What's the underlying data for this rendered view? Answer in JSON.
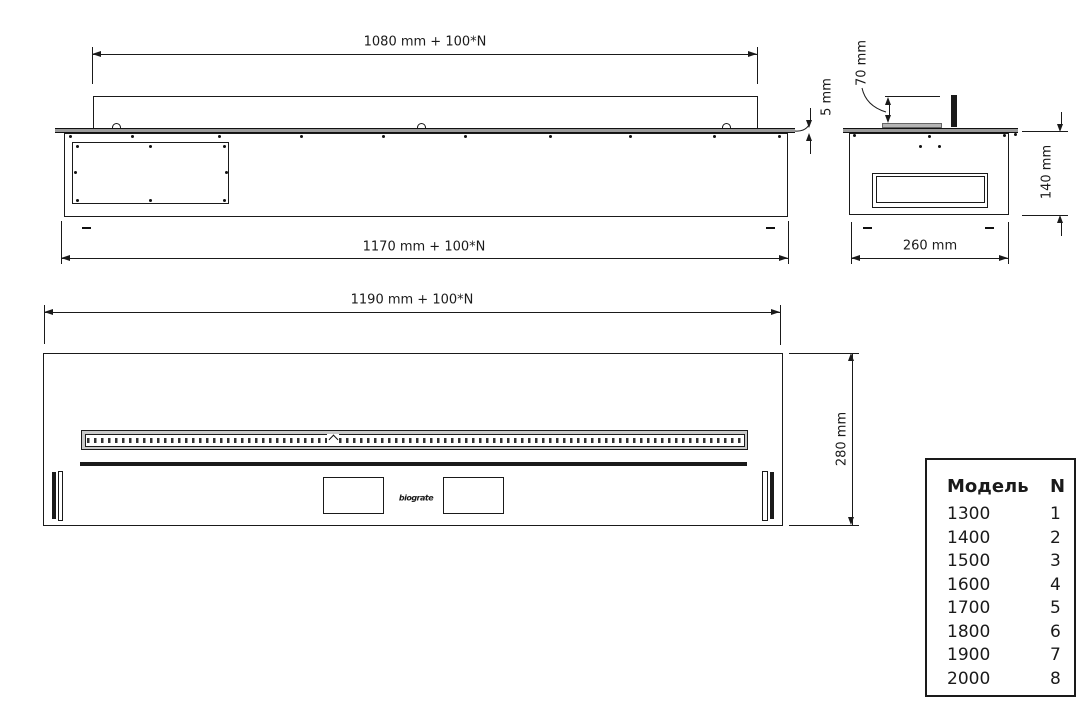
{
  "views": {
    "front": {
      "dim_top": "1080 mm + 100*N",
      "dim_bottom": "1170 mm + 100*N",
      "dim_lip": "5 mm"
    },
    "side": {
      "dim_insert_height": "70 mm",
      "dim_body_height": "140 mm",
      "dim_body_width": "260 mm"
    },
    "plan": {
      "dim_length": "1190 mm + 100*N",
      "dim_depth": "280 mm",
      "logo": "biograte"
    }
  },
  "table": {
    "headers": [
      "Модель",
      "N"
    ],
    "rows": [
      [
        "1300",
        "1"
      ],
      [
        "1400",
        "2"
      ],
      [
        "1500",
        "3"
      ],
      [
        "1600",
        "4"
      ],
      [
        "1700",
        "5"
      ],
      [
        "1800",
        "6"
      ],
      [
        "1900",
        "7"
      ],
      [
        "2000",
        "8"
      ]
    ]
  },
  "colors": {
    "line": "#1a1a1a",
    "flange_fill": "#9a9a9a",
    "plate_fill": "#b5b5b5"
  }
}
